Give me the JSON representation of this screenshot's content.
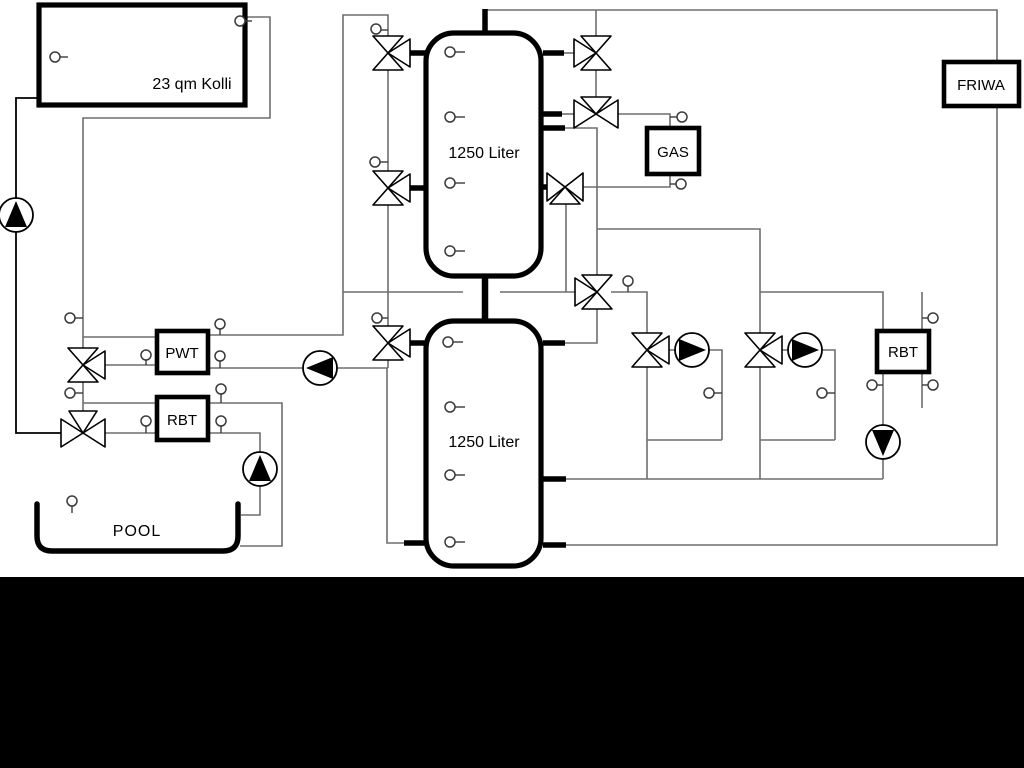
{
  "diagram": {
    "labels": {
      "collector": "23 qm Kolli",
      "tank_top": "1250 Liter",
      "tank_bottom": "1250 Liter",
      "pwt": "PWT",
      "rbt_left": "RBT",
      "gas": "GAS",
      "friwa": "FRIWA",
      "rbt_right": "RBT",
      "pool": "POOL"
    },
    "colors": {
      "background": "#ffffff",
      "pipe_line": "#6e6e6e",
      "component_stroke": "#000000",
      "letterbox": "#000000"
    }
  }
}
